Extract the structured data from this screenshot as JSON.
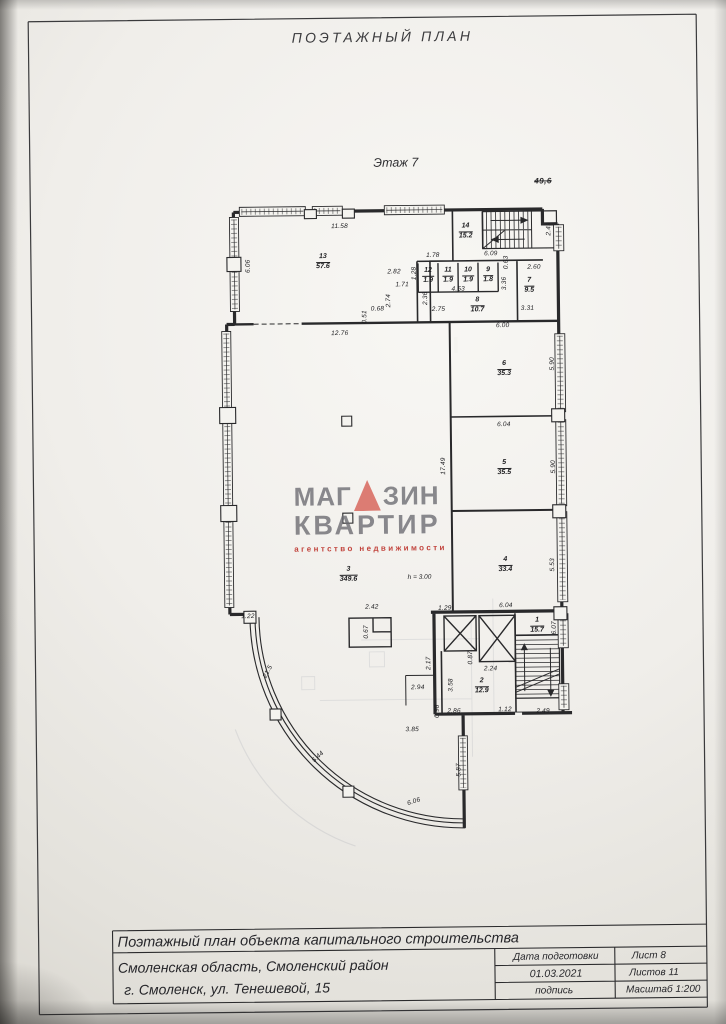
{
  "header": {
    "title": "ПОЭТАЖНЫЙ ПЛАН"
  },
  "plan": {
    "floor_label": "Этаж 7",
    "crossed_note": "49,6",
    "height_note": "h = 3.00",
    "rooms": [
      {
        "num": "13",
        "area": "57.6",
        "x": 326,
        "y": 262
      },
      {
        "num": "14",
        "area": "15.2",
        "x": 469,
        "y": 233
      },
      {
        "num": "12",
        "area": "1.9",
        "x": 431,
        "y": 277
      },
      {
        "num": "11",
        "area": "1.9",
        "x": 451,
        "y": 277
      },
      {
        "num": "10",
        "area": "1.9",
        "x": 471,
        "y": 277
      },
      {
        "num": "9",
        "area": "1.8",
        "x": 491,
        "y": 277
      },
      {
        "num": "8",
        "area": "10.7",
        "x": 480,
        "y": 307
      },
      {
        "num": "7",
        "area": "9.5",
        "x": 532,
        "y": 288
      },
      {
        "num": "6",
        "area": "35.3",
        "x": 506,
        "y": 371
      },
      {
        "num": "5",
        "area": "35.5",
        "x": 505,
        "y": 470
      },
      {
        "num": "4",
        "area": "33.4",
        "x": 505,
        "y": 567
      },
      {
        "num": "3",
        "area": "349.6",
        "x": 348,
        "y": 575
      },
      {
        "num": "2",
        "area": "12.9",
        "x": 480,
        "y": 688
      },
      {
        "num": "1",
        "area": "15.7",
        "x": 536,
        "y": 628
      }
    ],
    "dimensions": [
      {
        "t": "11.58",
        "x": 343,
        "y": 227,
        "r": 0
      },
      {
        "t": "6.06",
        "x": 252,
        "y": 265,
        "r": -90
      },
      {
        "t": "1.78",
        "x": 436,
        "y": 257,
        "r": 0
      },
      {
        "t": "1.28",
        "x": 418,
        "y": 274,
        "r": -90
      },
      {
        "t": "2.82",
        "x": 397,
        "y": 273,
        "r": 0
      },
      {
        "t": "1.71",
        "x": 405,
        "y": 286,
        "r": 0
      },
      {
        "t": "2.74",
        "x": 392,
        "y": 301,
        "r": -90
      },
      {
        "t": "2.36",
        "x": 429,
        "y": 299,
        "r": -90
      },
      {
        "t": "0.68",
        "x": 380,
        "y": 310,
        "r": 0
      },
      {
        "t": "0.51",
        "x": 368,
        "y": 317,
        "r": -90
      },
      {
        "t": "2.75",
        "x": 441,
        "y": 311,
        "r": 0
      },
      {
        "t": "4.53",
        "x": 461,
        "y": 291,
        "r": 0
      },
      {
        "t": "6.09",
        "x": 494,
        "y": 256,
        "r": 0
      },
      {
        "t": "2.49",
        "x": 553,
        "y": 231,
        "r": -90
      },
      {
        "t": "2.60",
        "x": 537,
        "y": 270,
        "r": 0
      },
      {
        "t": "0.63",
        "x": 510,
        "y": 264,
        "r": -90
      },
      {
        "t": "3.36",
        "x": 508,
        "y": 285,
        "r": -90
      },
      {
        "t": "3.31",
        "x": 530,
        "y": 311,
        "r": 0
      },
      {
        "t": "6.00",
        "x": 505,
        "y": 328,
        "r": 0
      },
      {
        "t": "12.76",
        "x": 342,
        "y": 334,
        "r": 0
      },
      {
        "t": "5.90",
        "x": 555,
        "y": 366,
        "r": -90
      },
      {
        "t": "6.04",
        "x": 505,
        "y": 427,
        "r": 0
      },
      {
        "t": "5.90",
        "x": 555,
        "y": 469,
        "r": -90
      },
      {
        "t": "17.49",
        "x": 445,
        "y": 467,
        "r": -90
      },
      {
        "t": "5.53",
        "x": 553,
        "y": 567,
        "r": -90
      },
      {
        "t": "6.04",
        "x": 505,
        "y": 608,
        "r": 0
      },
      {
        "t": "1.22",
        "x": 247,
        "y": 616,
        "r": 0
      },
      {
        "t": "2.42",
        "x": 371,
        "y": 608,
        "r": 0
      },
      {
        "t": "1.29",
        "x": 444,
        "y": 610,
        "r": 0
      },
      {
        "t": "0.67",
        "x": 366,
        "y": 632,
        "r": -90
      },
      {
        "t": "2.17",
        "x": 428,
        "y": 664,
        "r": -90
      },
      {
        "t": "0.87",
        "x": 470,
        "y": 659,
        "r": -90
      },
      {
        "t": "2.24",
        "x": 489,
        "y": 671,
        "r": 0
      },
      {
        "t": "6.07",
        "x": 554,
        "y": 630,
        "r": -90
      },
      {
        "t": "2.94",
        "x": 416,
        "y": 689,
        "r": 0
      },
      {
        "t": "3.58",
        "x": 450,
        "y": 686,
        "r": -90
      },
      {
        "t": "0.98",
        "x": 436,
        "y": 712,
        "r": -90
      },
      {
        "t": "2.86",
        "x": 452,
        "y": 713,
        "r": 0
      },
      {
        "t": "1.12",
        "x": 503,
        "y": 712,
        "r": 0
      },
      {
        "t": "2.49",
        "x": 541,
        "y": 714,
        "r": 0
      },
      {
        "t": "3.85",
        "x": 410,
        "y": 731,
        "r": 0
      },
      {
        "t": "5.87",
        "x": 457,
        "y": 771,
        "r": -90
      },
      {
        "t": "21.5",
        "x": 267,
        "y": 671,
        "r": -62
      },
      {
        "t": "5.44",
        "x": 316,
        "y": 757,
        "r": -42
      },
      {
        "t": "6.06",
        "x": 411,
        "y": 803,
        "r": -17
      }
    ]
  },
  "watermark": {
    "word1_left": "МАГ",
    "word1_right": "ЗИН",
    "word2": "КВАРТИР",
    "tagline": "агентство  недвижимости",
    "text_color": "#696970",
    "triangle_color": "#dc7c73",
    "tagline_color": "#c2453e"
  },
  "titleblock": {
    "main_title": "Поэтажный план объекта капитального строительства",
    "address_line1": "Смоленская область, Смоленский район",
    "address_line2": "г. Смоленск, ул. Тенешевой, 15",
    "prep_label": "Дата подготовки",
    "prep_date": "01.03.2021",
    "sheet": "Лист 8",
    "sheets": "Листов 11",
    "signature_label": "подпись",
    "scale": "Масштаб 1:200"
  }
}
